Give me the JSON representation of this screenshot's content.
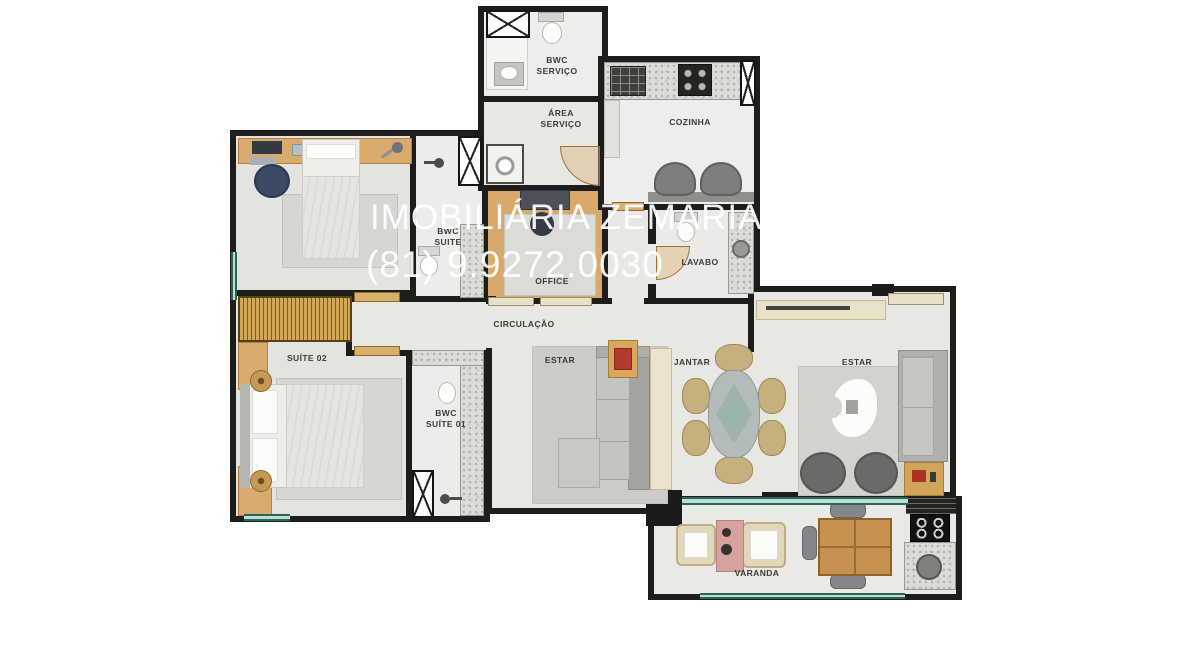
{
  "watermark": {
    "line1": "IMOBILIÁRIA ZEMARIA ET",
    "line2": "(81) 9.9272.0030"
  },
  "rooms": {
    "bwc_servico": {
      "line1": "BWC",
      "line2": "SERVIÇO"
    },
    "area_servico": {
      "line1": "ÁREA",
      "line2": "SERVIÇO"
    },
    "cozinha": {
      "label": "COZINHA"
    },
    "lavabo": {
      "label": "LAVABO"
    },
    "bwc_suite": {
      "line1": "BWC",
      "line2": "SUITE"
    },
    "office": {
      "label": "OFFICE"
    },
    "circulacao": {
      "label": "CIRCULAÇÃO"
    },
    "suite_02": {
      "label": "SUÍTE 02"
    },
    "bwc_suite_01": {
      "line1": "BWC",
      "line2": "SUÍTE 01"
    },
    "estar_left": {
      "label": "ESTAR"
    },
    "jantar": {
      "label": "JANTAR"
    },
    "estar_right": {
      "label": "ESTAR"
    },
    "varanda": {
      "label": "VARANDA"
    }
  },
  "colors": {
    "wall": "#1d1d1c",
    "floor": "#e7e7e4",
    "wood_floor": "#d9a96b",
    "wood_furniture": "#d9ab6c",
    "wardrobe_gold": "#d2a757",
    "granite": "#dcdcd7",
    "window_glass": "#b9e0d5",
    "rug_gray": "#d6d6d2",
    "sofa_gray": "#b4b4b1",
    "accent_red": "#b23a2e",
    "watermark_white": "#ffffff",
    "label_text": "#3b3b3b"
  }
}
